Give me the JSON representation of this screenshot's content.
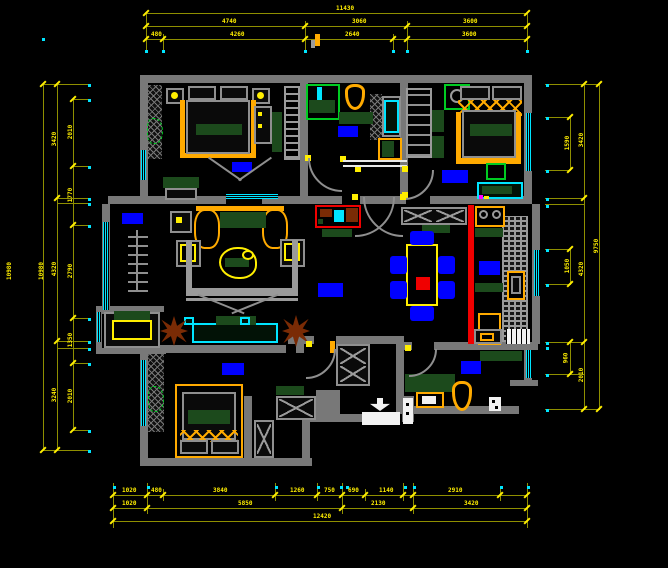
{
  "drawing": {
    "title": "apartment-floor-plan-cad",
    "units": "mm",
    "colors": {
      "background": "#000000",
      "walls": "#787878",
      "dimension_text": "#ffee00",
      "dimension_lines": "#8f8f00",
      "extension_dots": "#00e5ff",
      "windows": "#00e5ff",
      "furniture_frames": "#ffaa00",
      "soft_furnishings": "#1c4a1c",
      "text_label_blocks": "#0000ff",
      "highlight_partition": "#f00000",
      "plants": "#7a2b05"
    },
    "icons": [
      {
        "name": "entry-arrow-icon"
      },
      {
        "name": "shower-head-icon"
      },
      {
        "name": "ceiling-fan-icon"
      },
      {
        "name": "stove-burner-icon"
      }
    ],
    "rooms_visible": [
      "bedroom-top-left",
      "bathroom-top",
      "bedroom-top-right",
      "living-room",
      "dining-room",
      "kitchen",
      "bedroom-bottom-left",
      "bathroom-bottom",
      "entry-hall"
    ],
    "dimensions": {
      "top": [
        {
          "t": "11430",
          "x": 336,
          "y": 6
        },
        {
          "t": "4740",
          "x": 222,
          "y": 19
        },
        {
          "t": "3060",
          "x": 352,
          "y": 19
        },
        {
          "t": "3600",
          "x": 463,
          "y": 19
        },
        {
          "t": "480",
          "x": 151,
          "y": 32
        },
        {
          "t": "4260",
          "x": 230,
          "y": 32
        },
        {
          "t": "2640",
          "x": 345,
          "y": 32
        },
        {
          "t": "3600",
          "x": 462,
          "y": 32
        }
      ],
      "bottom": [
        {
          "t": "1020",
          "x": 122,
          "y": 488
        },
        {
          "t": "480",
          "x": 151,
          "y": 488
        },
        {
          "t": "3840",
          "x": 213,
          "y": 488
        },
        {
          "t": "1260",
          "x": 290,
          "y": 488
        },
        {
          "t": "750",
          "x": 324,
          "y": 488
        },
        {
          "t": "690",
          "x": 348,
          "y": 488
        },
        {
          "t": "1140",
          "x": 379,
          "y": 488
        },
        {
          "t": "2910",
          "x": 448,
          "y": 488
        },
        {
          "t": "1020",
          "x": 122,
          "y": 501
        },
        {
          "t": "5850",
          "x": 238,
          "y": 501
        },
        {
          "t": "2130",
          "x": 371,
          "y": 501
        },
        {
          "t": "3420",
          "x": 464,
          "y": 501
        },
        {
          "t": "12420",
          "x": 313,
          "y": 514
        }
      ],
      "left": [
        {
          "t": "10980",
          "x": 1,
          "y": 268
        },
        {
          "t": "10980",
          "x": 33,
          "y": 268
        },
        {
          "t": "3420",
          "x": 48,
          "y": 136
        },
        {
          "t": "4320",
          "x": 48,
          "y": 266
        },
        {
          "t": "3240",
          "x": 48,
          "y": 392
        },
        {
          "t": "2010",
          "x": 64,
          "y": 129
        },
        {
          "t": "1770",
          "x": 64,
          "y": 192
        },
        {
          "t": "2790",
          "x": 64,
          "y": 268
        },
        {
          "t": "1350",
          "x": 64,
          "y": 337
        },
        {
          "t": "2010",
          "x": 64,
          "y": 393
        }
      ],
      "right": [
        {
          "t": "3420",
          "x": 575,
          "y": 137
        },
        {
          "t": "4320",
          "x": 575,
          "y": 266
        },
        {
          "t": "2010",
          "x": 575,
          "y": 372
        },
        {
          "t": "9750",
          "x": 590,
          "y": 243
        },
        {
          "t": "1590",
          "x": 561,
          "y": 140
        },
        {
          "t": "1050",
          "x": 561,
          "y": 263
        },
        {
          "t": "960",
          "x": 561,
          "y": 355
        }
      ]
    }
  }
}
